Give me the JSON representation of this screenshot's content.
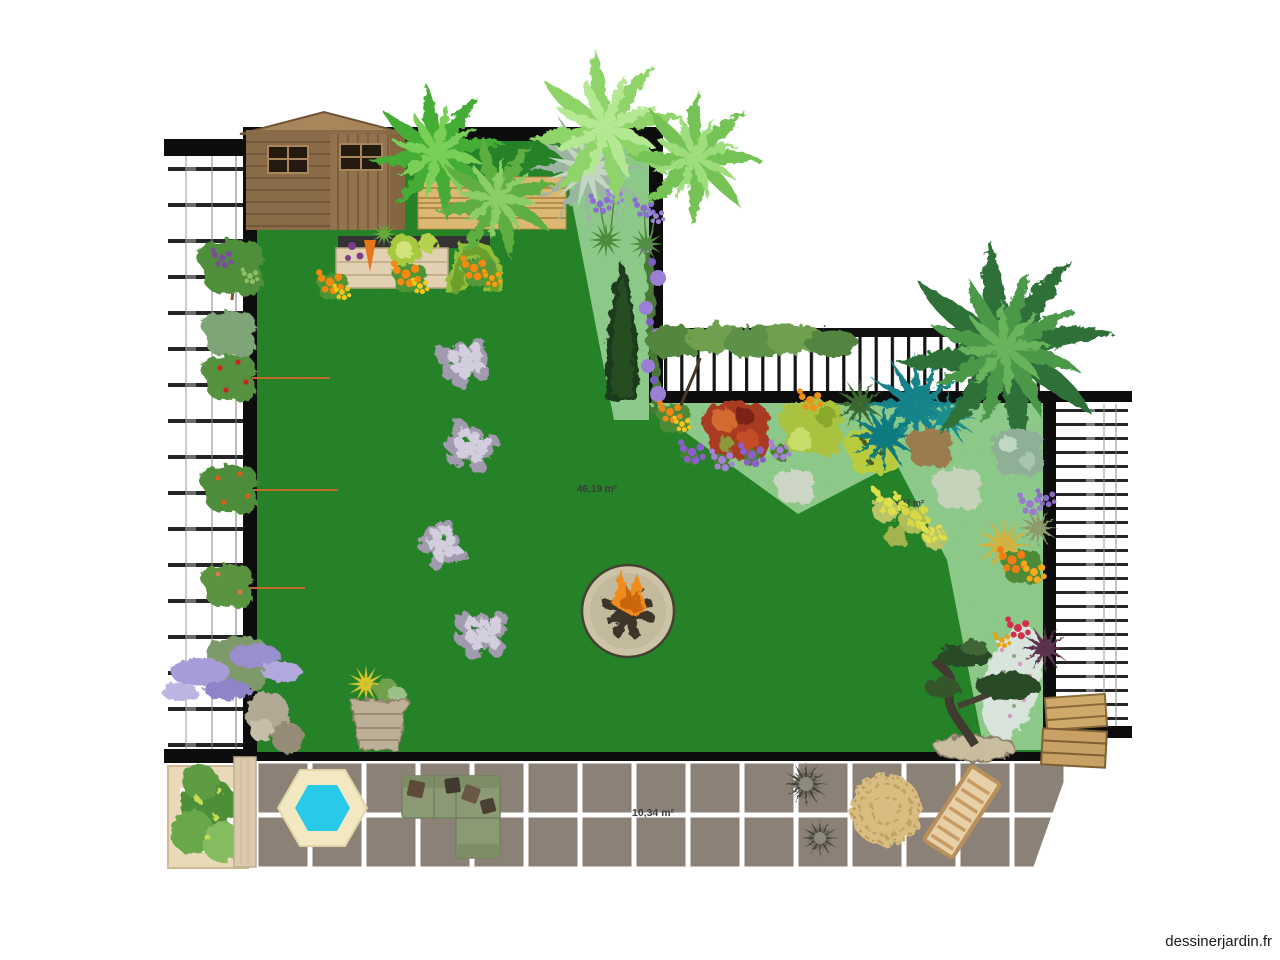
{
  "page": {
    "watermark": "dessinerjardin.fr"
  },
  "plan": {
    "zones": [
      {
        "name": "lawn",
        "label": "46,19 m²",
        "color": "#1e7a1e"
      },
      {
        "name": "flower-bed",
        "label": "4,97 m²",
        "color": "#9bd497"
      },
      {
        "name": "terrace",
        "label": "10,34 m²",
        "color": "#8b8177"
      }
    ],
    "colors": {
      "wall": "#0d0d0d",
      "bed_green": "#9bd497",
      "lawn_green": "#1e7a1e",
      "tile_grout": "#ffffff",
      "pool_border": "#f2e8c2",
      "pool_water": "#29c9e8",
      "wood_light": "#dcb872",
      "shed_wood": "#8a6b48",
      "sofa_green": "#8b9a74"
    },
    "objects": [
      "garden-shed",
      "wood-screen",
      "palm-trees",
      "raised-vegetable-bed",
      "topiary-arch",
      "nasturtium-flowers",
      "espalier-trees",
      "wisteria",
      "stepping-stones",
      "fire-pit",
      "rock",
      "stone-planter",
      "cypress-tree",
      "clematis-vine",
      "astelia",
      "agapanthus",
      "pleached-hedge",
      "railing-fence",
      "trellis-fence",
      "red-shrub",
      "purple-flowers",
      "teal-cordylines",
      "big-palm",
      "euphorbia",
      "lavender",
      "marigolds",
      "gypsophila",
      "bonsai-tree",
      "wooden-crates",
      "hexagonal-pool",
      "corner-sofa",
      "wicker-chairs",
      "wicker-pouf",
      "wooden-bench",
      "pallet-planter"
    ]
  }
}
